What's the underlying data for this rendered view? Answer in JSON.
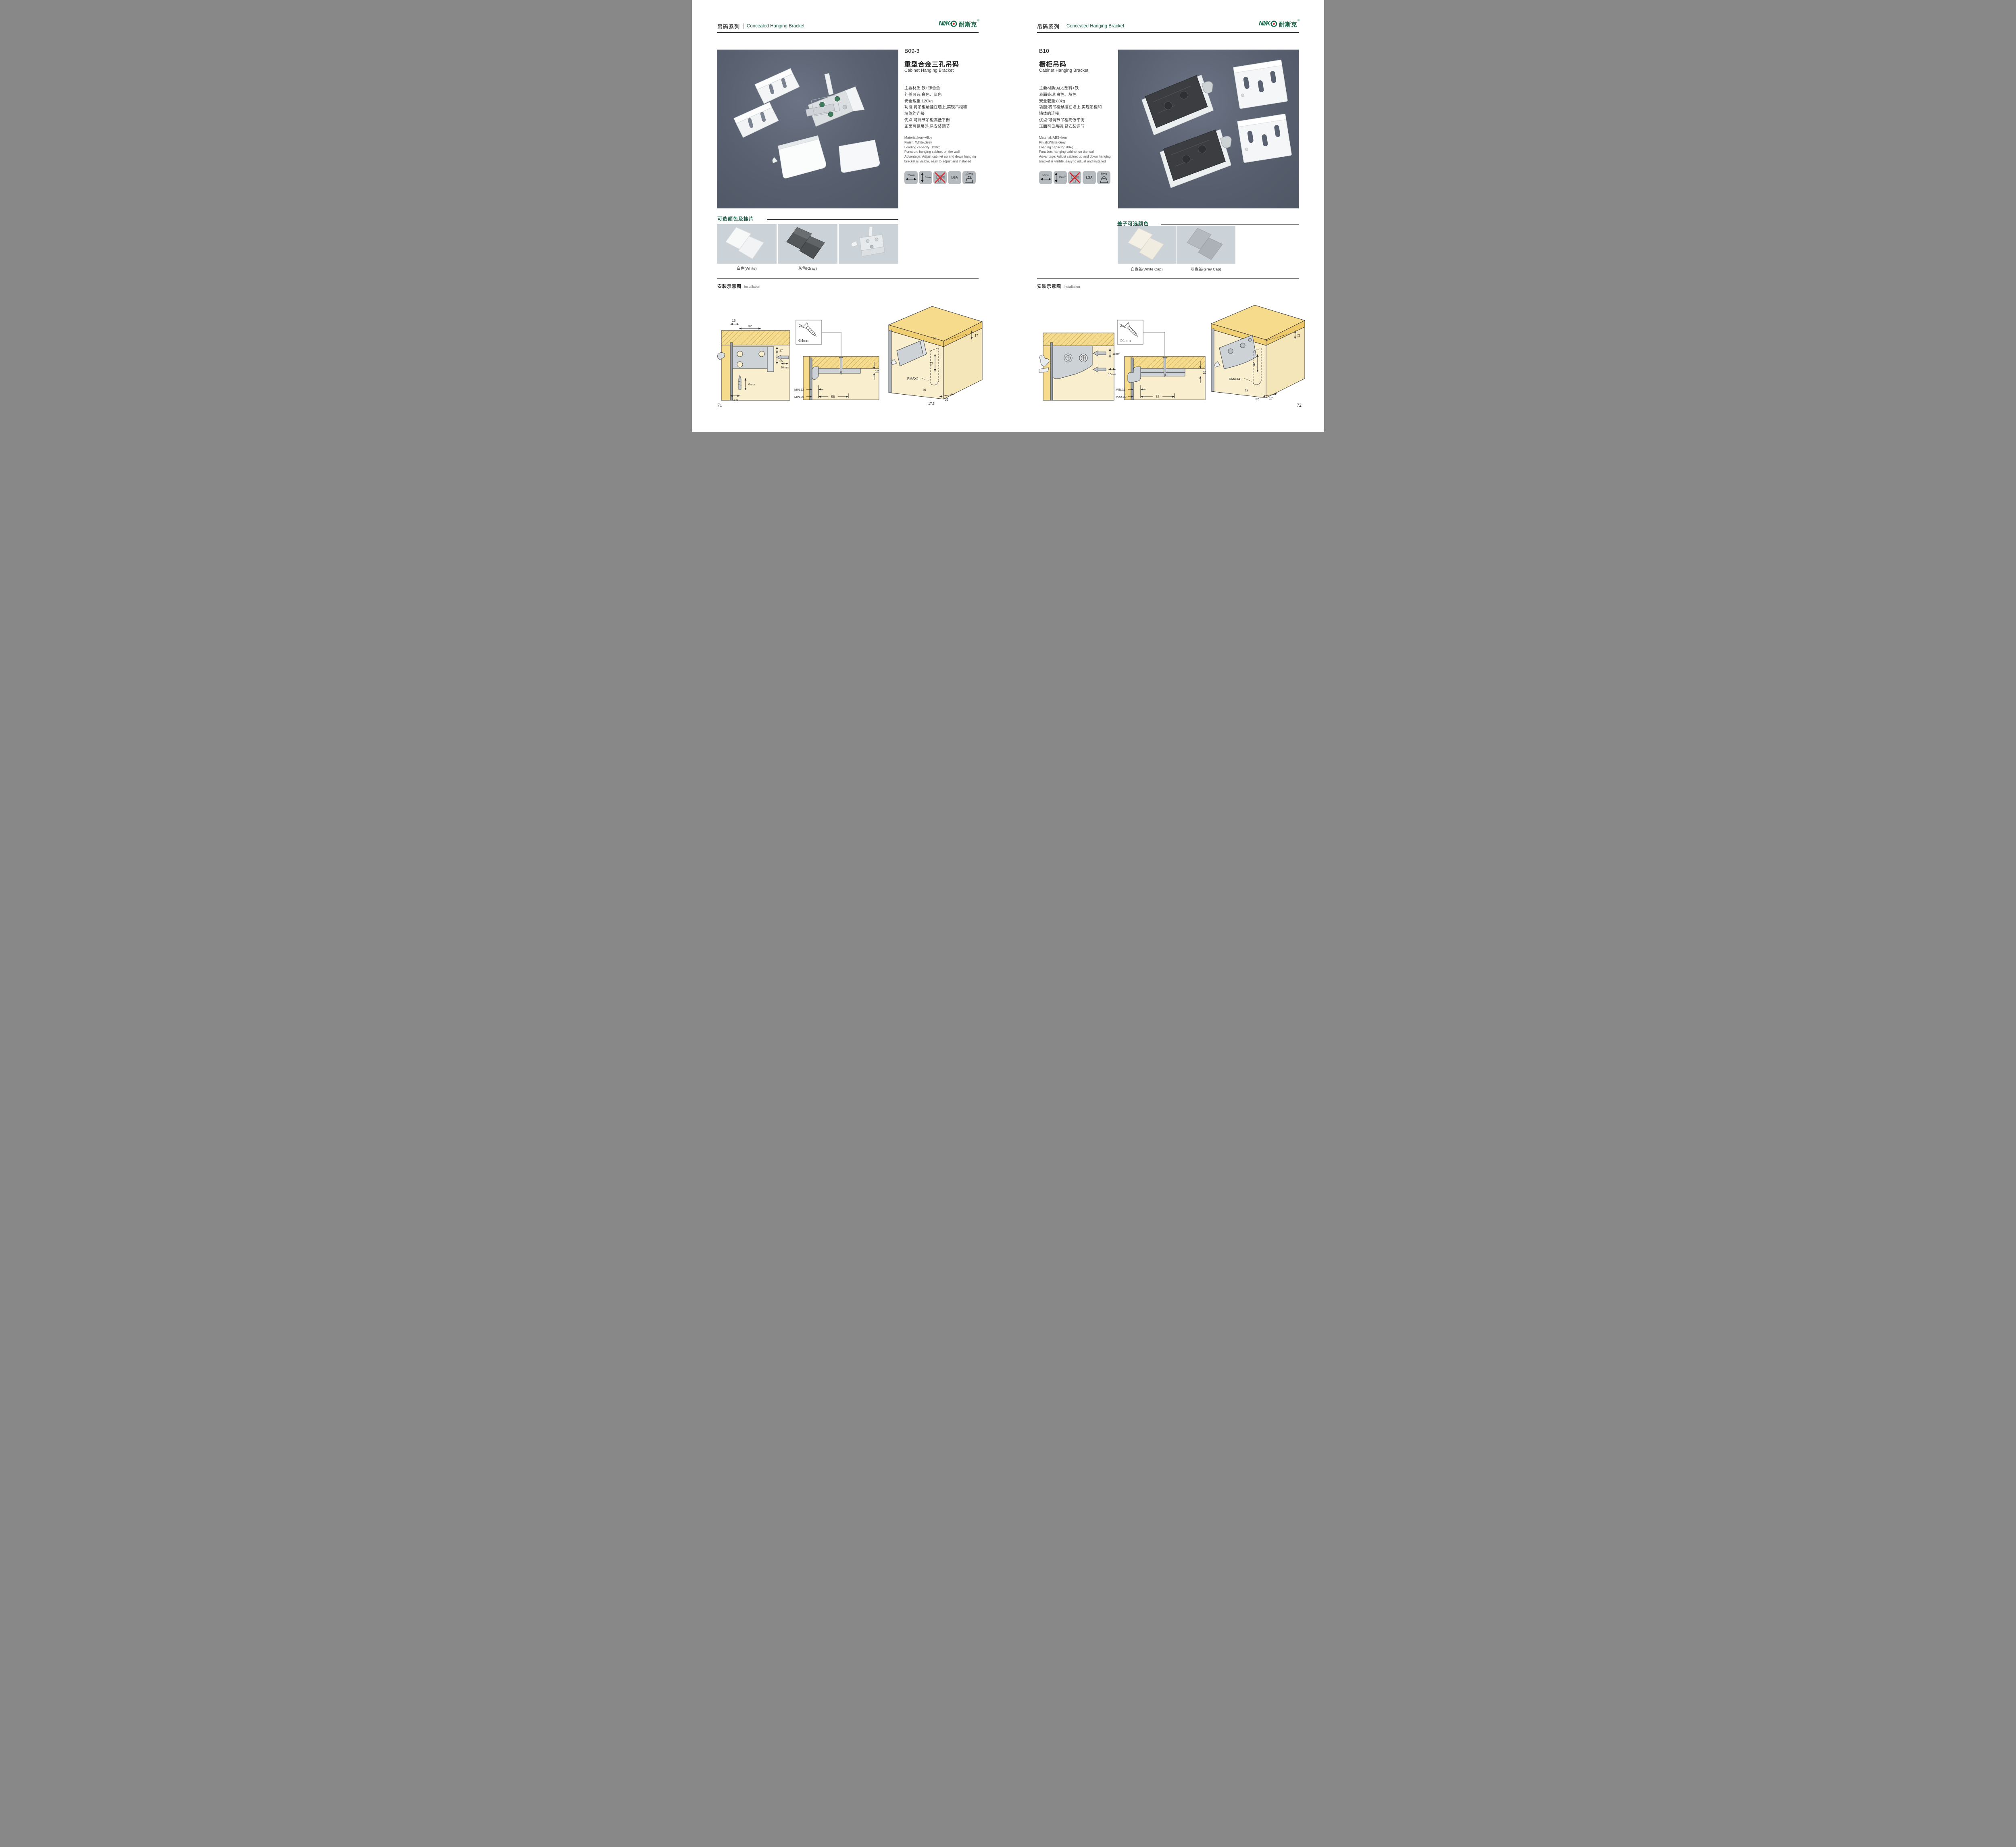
{
  "header": {
    "series_cn": "吊码系列",
    "series_en": "Concealed Hanging Bracket"
  },
  "brand": {
    "logo_latin": "NI/K",
    "logo_o": "Ɵ",
    "logo_cn": "耐斯克",
    "reg": "®"
  },
  "colors": {
    "accent_green": "#1d5c46",
    "logo_green": "#156b4a",
    "logo_red": "#e02222",
    "photo_bg": "#5a6272",
    "swatch_bg": "#ccd3d8",
    "badge_bg": "#b5babe",
    "wood": "#f7db8d",
    "cabinet_interior": "#f9efcf",
    "no_drill_red": "#cc2229"
  },
  "page_left": {
    "page_number": "71",
    "product": {
      "code": "B09-3",
      "name_cn": "重型合金三孔吊码",
      "name_en": "Cabinet Hanging Bracket",
      "specs_cn": [
        "主要材质:铁+锌合金",
        "外盖可选:白色、灰色",
        "安全载重:120kg",
        "功能:将吊柜悬挂在墙上,实现吊柜和",
        "墙体的连接",
        "优点:可调节吊柜高低平衡",
        "正面可见吊码,易安装调节"
      ],
      "specs_en": [
        "Material:Iron+Alloy",
        "Finish: White,Grey",
        "Loading capacity: 120kg",
        "Function: hanging cabinet on the wall",
        "Advantage: Adjust cabinet up and down hanging",
        "bracket is visible, easy to adjust and installed"
      ],
      "badges": {
        "width": "20mm",
        "depth": "6mm",
        "cert": "LGA",
        "load": "120Kg"
      }
    },
    "colors_section": {
      "title": "可选颜色及挂片",
      "swatch1_label": "白色(White)",
      "swatch2_label": "灰色(Gray)"
    },
    "installation": {
      "title_cn": "安装示意图",
      "title_en": "Installation",
      "d1": {
        "top1": "16",
        "top2": "32",
        "right1": "17",
        "right2": "25",
        "bit": "20mm",
        "screw": "6mm",
        "bottom": "17.5"
      },
      "d2": {
        "qty": "2x",
        "dia": "Φ4mm",
        "thickness": "12",
        "row1": "MIN.12",
        "row2": "MIN.35",
        "span": "58"
      },
      "d3": {
        "a": "16",
        "b": "17",
        "c": "42",
        "r": "RMAX4",
        "e": "16",
        "f": "32",
        "g": "17.5"
      }
    }
  },
  "page_right": {
    "page_number": "72",
    "product": {
      "code": "B10",
      "name_cn": "橱柜吊码",
      "name_en": "Cabinet Hanging Bracket",
      "specs_cn": [
        "主要材质:ABS塑料+铁",
        "表面处理:白色、灰色",
        "安全载重:80kg",
        "功能:将吊柜悬挂在墙上,实现吊柜和",
        "墙体的连接",
        "优点:可调节吊柜高低平衡",
        "正面可见吊码,易安装调节"
      ],
      "specs_en": [
        "Material: ABS+iron",
        "Finish:White,Grey",
        "Loading capacity: 80kg",
        "Function: hanging cabinet on the wall",
        "Advantage: Adjust cabinet up and down hanging",
        "bracket is visible, easy to adjust and installed"
      ],
      "badges": {
        "width": "10mm",
        "depth": "15mm",
        "cert": "LGA",
        "load": "80Kg"
      }
    },
    "colors_section": {
      "title": "盖子可选颜色",
      "swatch1_label": "白色盖(White Cap)",
      "swatch2_label": "灰色盖(Gray Cap)"
    },
    "installation": {
      "title_cn": "安装示意图",
      "title_en": "Installation",
      "d1": {
        "v": "15mm",
        "h": "10mm"
      },
      "d2": {
        "qty": "2x",
        "dia": "Φ4mm",
        "thickness": "18",
        "row1": "MIN.12",
        "row2": "MAX.30",
        "span": "67"
      },
      "d3": {
        "b": "13",
        "c": "42",
        "r": "RMAX4",
        "e": "19",
        "f": "17",
        "g": "32"
      }
    }
  }
}
